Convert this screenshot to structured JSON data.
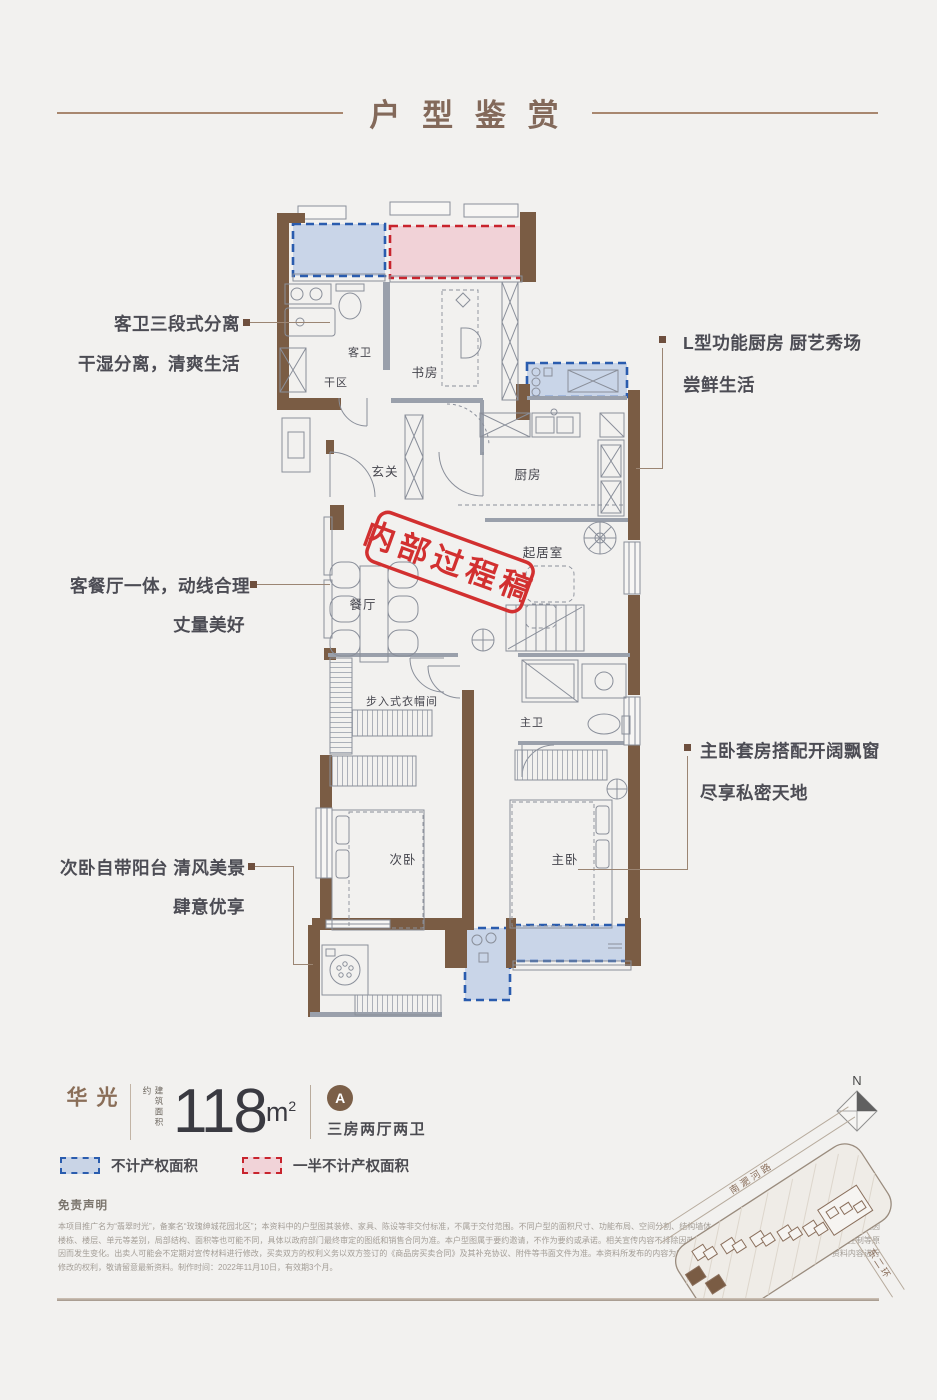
{
  "header": {
    "title": "户 型 鉴 赏"
  },
  "callouts": {
    "left": [
      {
        "line1": "客卫三段式分离",
        "line2": "干湿分离，清爽生活"
      },
      {
        "line1": "客餐厅一体，动线合理",
        "line2": "丈量美好"
      },
      {
        "line1": "次卧自带阳台 清风美景",
        "line2": "肆意优享"
      }
    ],
    "right": [
      {
        "line1": "L型功能厨房 厨艺秀场",
        "line2": "尝鲜生活"
      },
      {
        "line1": "主卧套房搭配开阔飘窗",
        "line2": "尽享私密天地"
      }
    ]
  },
  "floorplan": {
    "stamp": "内部过程稿",
    "rooms": {
      "study": "书房",
      "guest_bath": "客卫",
      "dry_area": "干区",
      "foyer": "玄关",
      "kitchen": "厨房",
      "living": "起居室",
      "dining": "餐厅",
      "closet": "步入式衣帽间",
      "master_bath": "主卫",
      "second_bedroom": "次卧",
      "master_bedroom": "主卧"
    }
  },
  "spec": {
    "name": "光华",
    "area_label": "建筑面积约",
    "area_value": "118",
    "area_unit": "m",
    "area_exp": "2",
    "unit_badge": "A",
    "layout": "三房两厅两卫"
  },
  "legend": {
    "blue": "不计产权面积",
    "red": "一半不计产权面积"
  },
  "disclaimer": {
    "title": "免责声明",
    "body": "本项目推广名为“翡翠时光”，备案名“玫瑰绅城花园北区”；本资料中的户型图其装修、家具、陈设等非交付标准，不属于交付范围。不同户型的面积尺寸、功能布局、空间分割、结构墙体、门窗及管井形态位置等均有不同。相同户型因楼栋、楼层、单元等差别，局部结构、面积等也可能不同，具体以政府部门最终审定的图纸和销售合同为准。本户型图属于要约邀请，不作为要约或承诺。相关宣传内容不排除因政府相关规划、规定及出卖人分期规划、未能控制等原因而发生变化。出卖人可能会不定期对宣传材料进行修改，买卖双方的权利义务以双方签订的《商品房买卖合同》及其补充协议、附件等书面文件为准。本资料所发布的内容为2022年11月10日前的信息，本公司保留对本资料内容进行修改的权利，敬请留意最新资料。制作时间：2022年11月10日，有效期3个月。"
  },
  "sitemap": {
    "north": "N",
    "road_top": "南淝河路",
    "road_right": "东二环"
  },
  "colors": {
    "accent_brown": "#8a7161",
    "wall_brown": "#7a5c44",
    "zone_blue": "#2a5cae",
    "zone_red": "#c8242d",
    "stamp_red": "#d23030"
  }
}
